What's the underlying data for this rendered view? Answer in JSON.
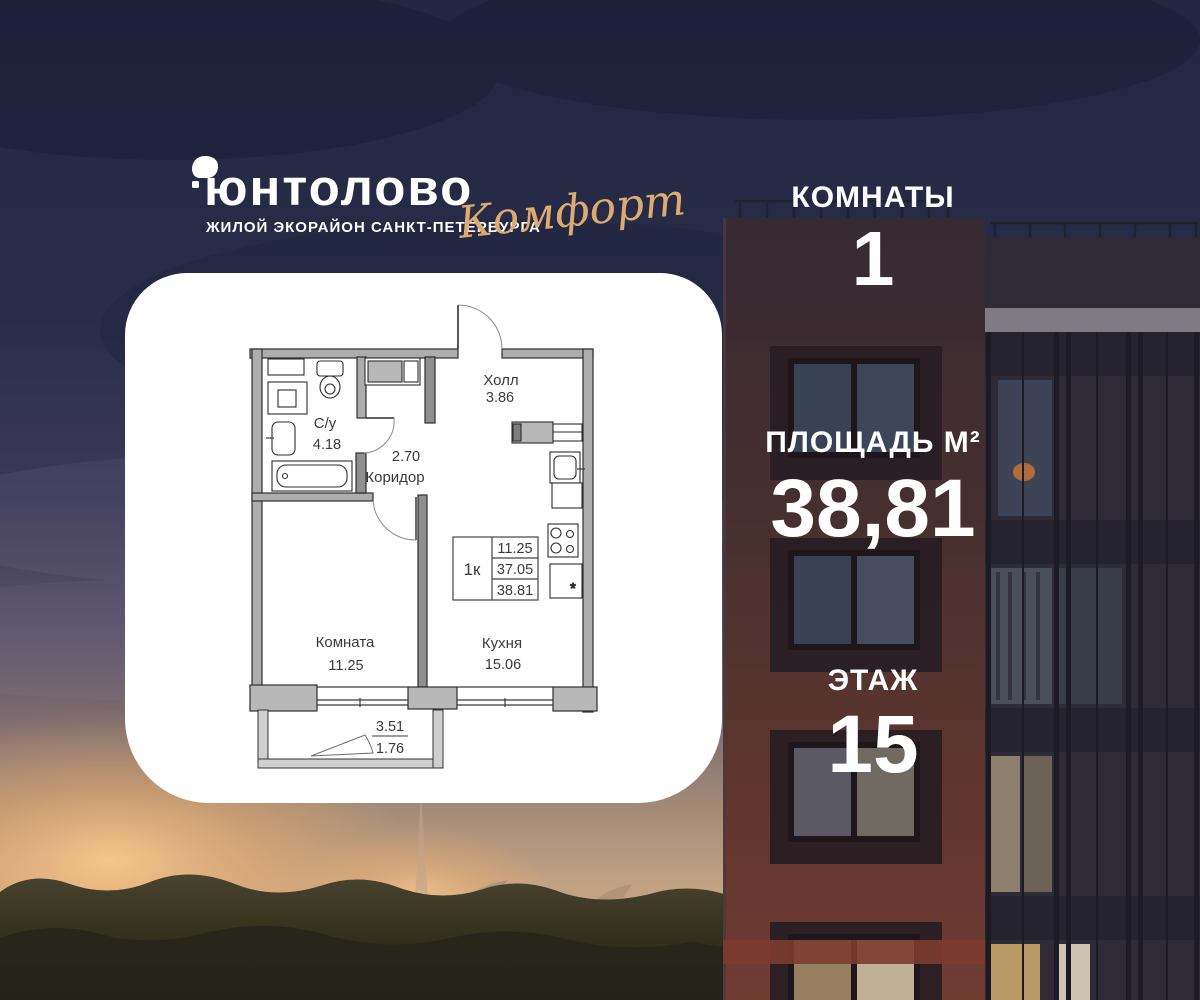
{
  "brand": {
    "title": "юнтолово",
    "subtitle": "ЖИЛОЙ ЭКОРАЙОН САНКТ-ПЕТЕРБУРГА",
    "collection": "Комфорт"
  },
  "stats": {
    "rooms": {
      "label": "КОМНАТЫ",
      "value": "1"
    },
    "area": {
      "label": "ПЛОЩАДЬ М²",
      "value": "38,81"
    },
    "floor": {
      "label": "ЭТАЖ",
      "value": "15"
    }
  },
  "plan": {
    "hall": {
      "name": "Холл",
      "area": "3.86"
    },
    "bathroom": {
      "name": "С/у",
      "area": "4.18"
    },
    "corridor": {
      "name": "Коридор",
      "area": "2.70"
    },
    "room": {
      "name": "Комната",
      "area": "11.25"
    },
    "kitchen": {
      "name": "Кухня",
      "area": "15.06"
    },
    "balcony": {
      "area_full": "3.51",
      "area_counted": "1.76"
    },
    "summary": {
      "type": "1к",
      "living_area": "11.25",
      "area_without_balcony": "37.05",
      "total_area": "38.81"
    },
    "fridge_mark": "*"
  },
  "colors": {
    "accent_gold": "#dcab72",
    "card_bg": "#ffffff",
    "plan_ink": "#3a3a3a",
    "sky_top": "#222640",
    "sunset_glow": "#f0b070",
    "brick": "#6f3c32"
  }
}
